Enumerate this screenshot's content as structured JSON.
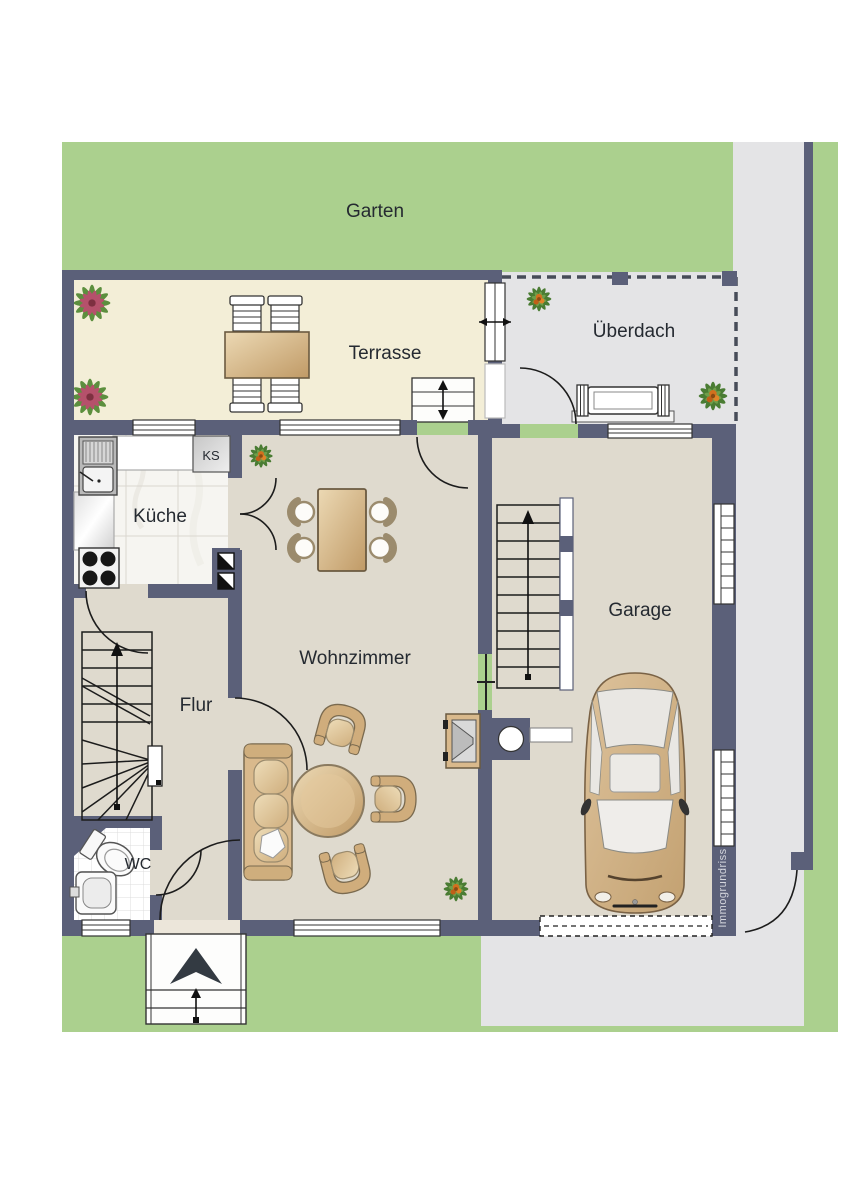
{
  "labels": {
    "garten": "Garten",
    "terrasse": "Terrasse",
    "ueberdach": "Überdach",
    "kueche": "Küche",
    "ks": "KS",
    "wohnzimmer": "Wohnzimmer",
    "flur": "Flur",
    "wc": "WC",
    "garage": "Garage",
    "watermark": "Immogrundriss"
  },
  "palette": {
    "garden_green": "#abd08e",
    "paving_gray": "#e4e4e6",
    "terrace_cream": "#f3eed7",
    "floor_beige": "#dfdace",
    "kitchen_floor": "#f6f5f1",
    "wall_navy": "#5b6079",
    "wood_tan": "#d9b98c",
    "wood_dark": "#7a6a4f",
    "cushion_light": "#e9d5b0",
    "car_tan": "#d3b285",
    "label_text": "#252a31",
    "watermark_text": "#d4d6dd",
    "plant_green": "#4a7c33",
    "plant_light_green": "#6f9e4a",
    "plant_red": "#b5516b",
    "plant_orange": "#d2701e"
  }
}
